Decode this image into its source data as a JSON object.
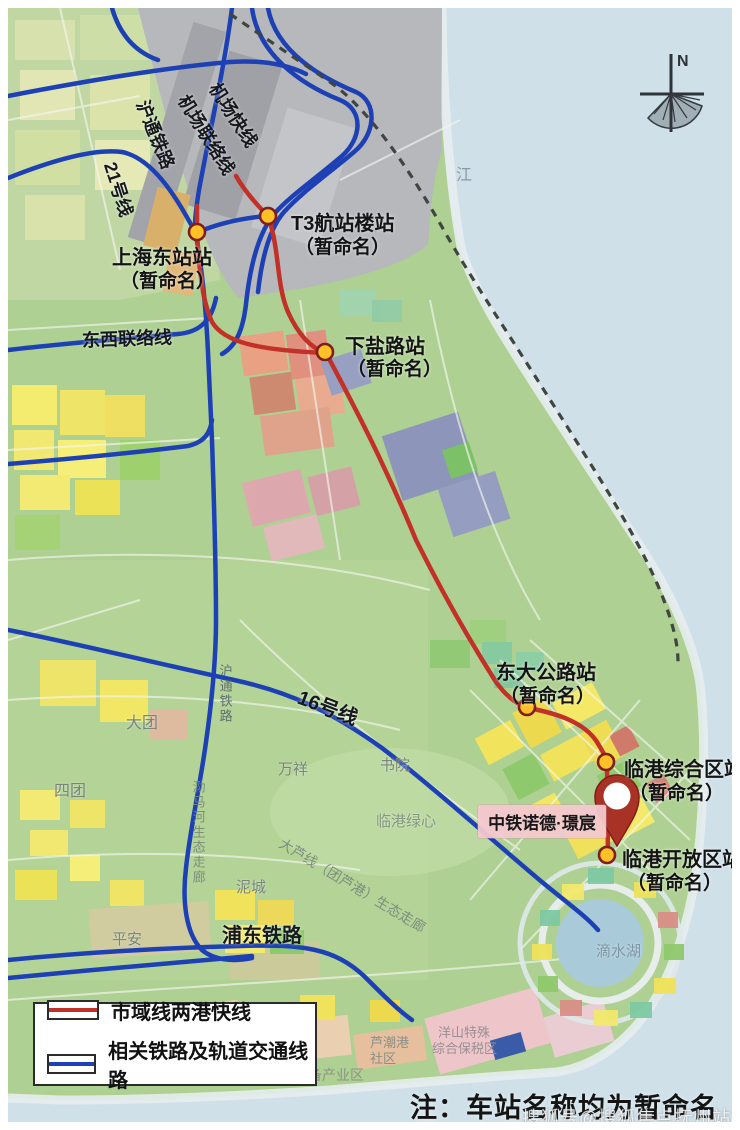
{
  "compass": {
    "north": "N"
  },
  "water_label": "江",
  "stations": [
    {
      "name": "上海东站站",
      "subtitle": "（暂命名）"
    },
    {
      "name": "T3航站楼站",
      "subtitle": "（暂命名）"
    },
    {
      "name": "下盐路站",
      "subtitle": "（暂命名）"
    },
    {
      "name": "东大公路站",
      "subtitle": "（暂命名）"
    },
    {
      "name": "临港综合区站",
      "subtitle": "（暂命名）"
    },
    {
      "name": "临港开放区站",
      "subtitle": "（暂命名）"
    }
  ],
  "rail_labels": {
    "airport_express": "机场快线",
    "airport_link_line": "机场联络线",
    "hutong_railway": "沪通铁路",
    "line_21": "21号线",
    "east_west_link": "东西联络线",
    "line_16": "16号线",
    "pudong_railway": "浦东铁路",
    "hutong_railway_south": "沪通铁路"
  },
  "corridor_labels": {
    "lema_river": "泐马河生态走廊",
    "dalu_line": "大芦线（团芦港）生态走廊"
  },
  "area_labels": {
    "datuan": "大团",
    "situan": "四团",
    "wanxiang": "万祥",
    "shuyuan": "书院",
    "lingang_green_heart": "临港绿心",
    "pingan": "平安",
    "nicheng": "泥城",
    "dishui_lake": "滴水湖",
    "luchaogang_line1": "芦潮港",
    "luchaogang_line2": "社区",
    "yangshan_line1": "洋山特殊",
    "yangshan_line2": "综合保税区",
    "equipment_industry": "装备产业区"
  },
  "poi": {
    "name": "中铁诺德·璟宸"
  },
  "legend": {
    "items": [
      {
        "label": "市域线两港快线",
        "color": "#c23128"
      },
      {
        "label": "相关铁路及轨道交通线路",
        "color": "#1d41b4"
      }
    ]
  },
  "note": "注：车站名称均为暂命名",
  "watermark": "搜狐号@搜狐焦点抚州站",
  "colors": {
    "regional_line": "#c23128",
    "rail_line": "#1d41b4",
    "station_fill": "#ffc125",
    "water": "#cfe0e9",
    "airport": "#b6b8bc"
  }
}
